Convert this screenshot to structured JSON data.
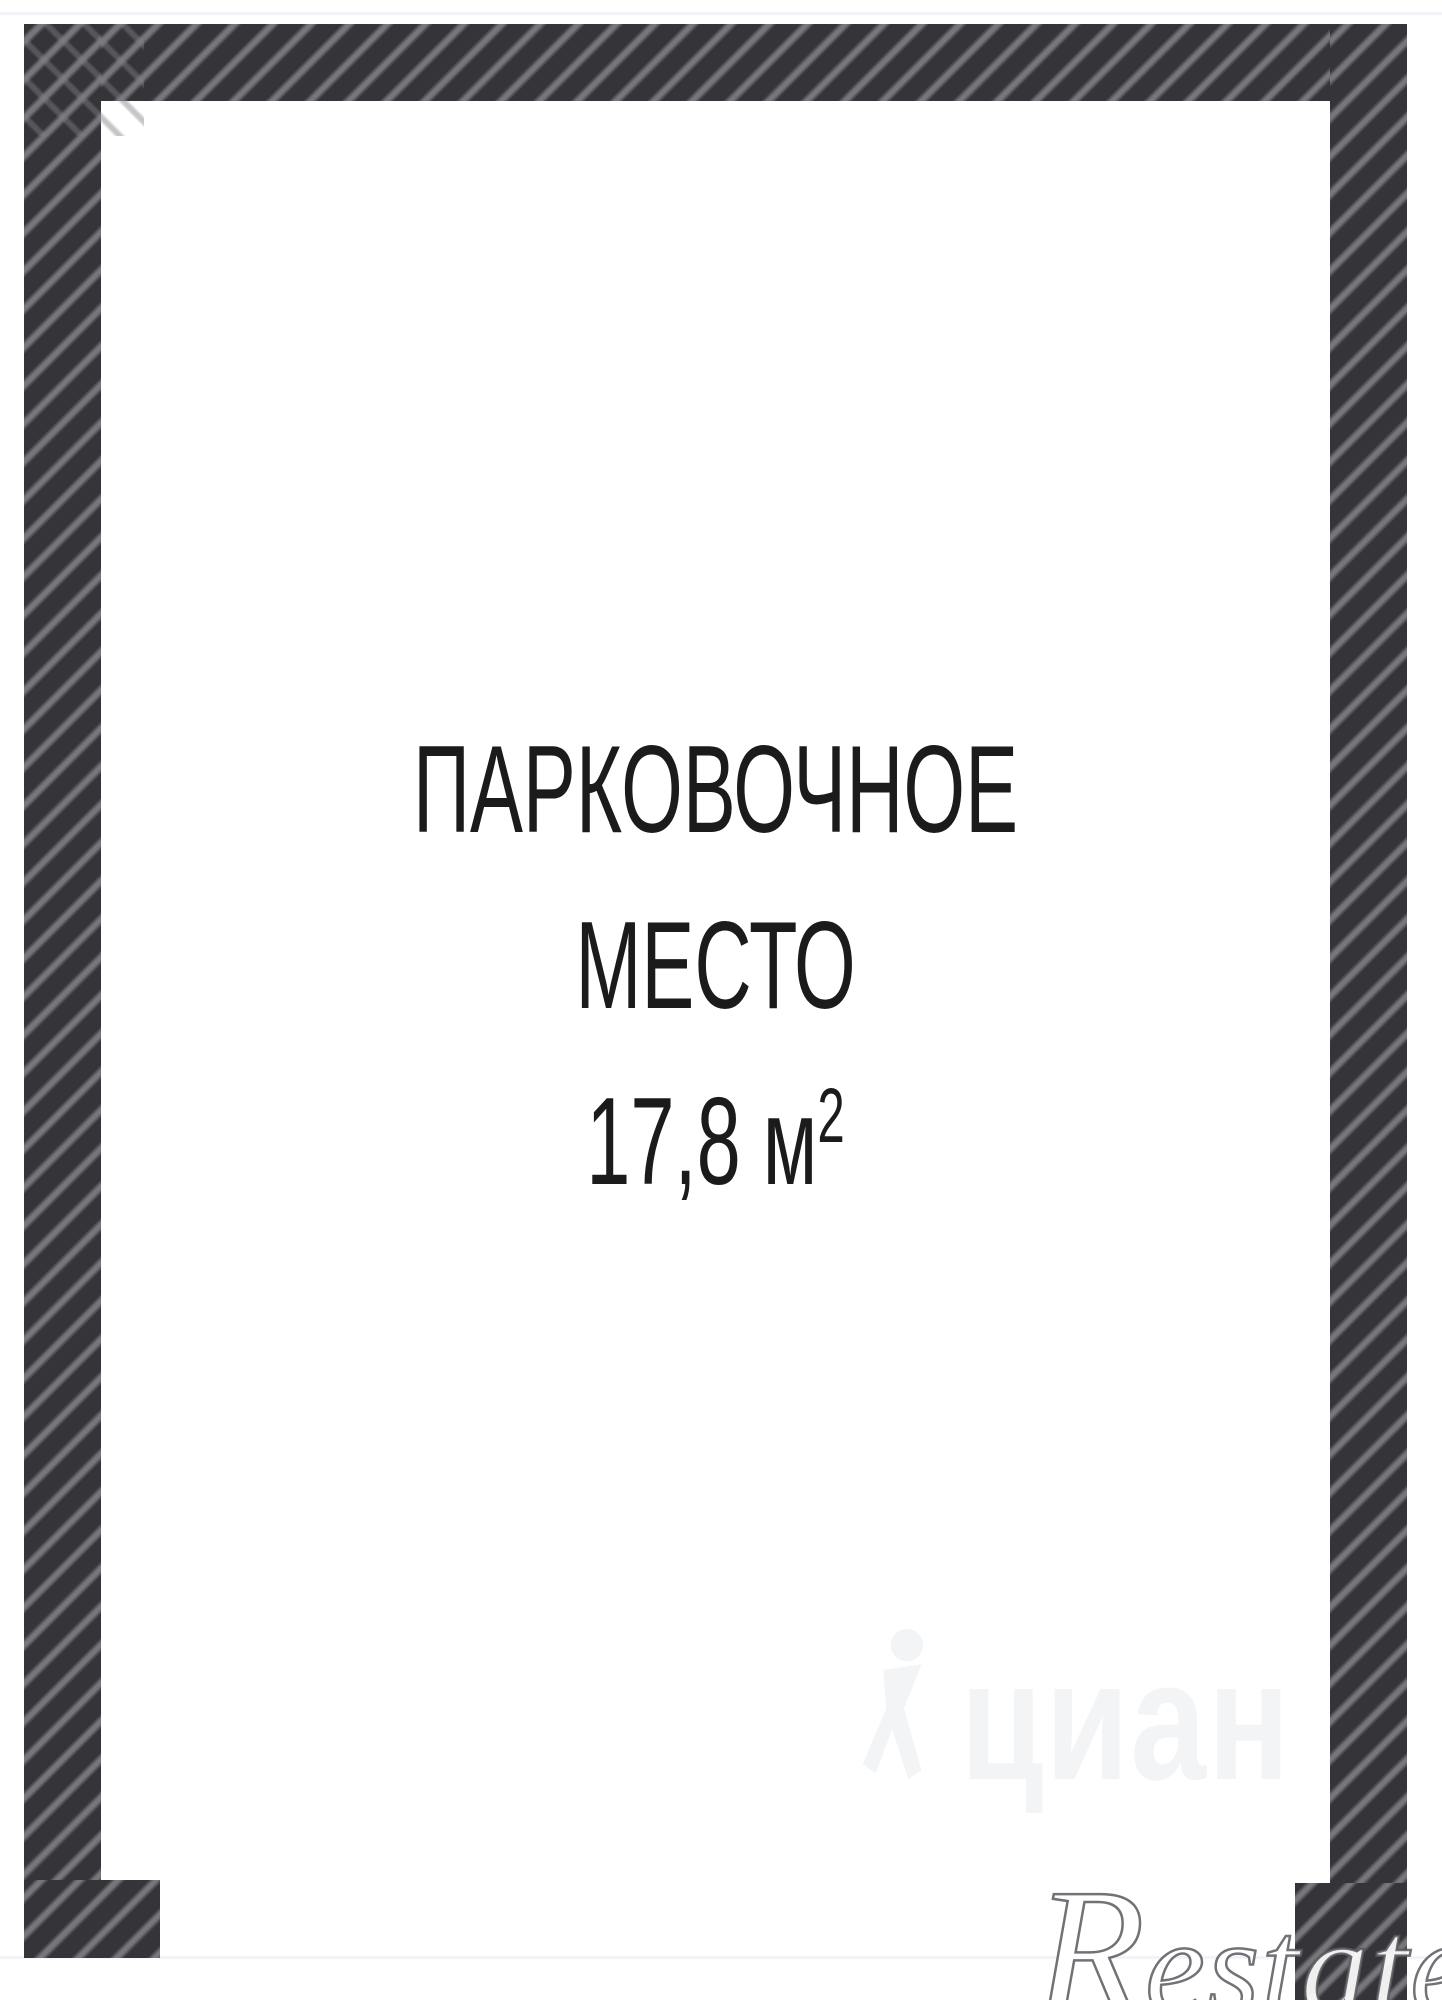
{
  "plan": {
    "label_line1": "ПАРКОВОЧНОЕ",
    "label_line2": "МЕСТО",
    "area_main": "17,8 м",
    "area_sup": "2"
  },
  "watermarks": {
    "cian_text": "циан",
    "cian_icon": "cian-person-icon",
    "restate_initial": "R",
    "restate_rest": "estate"
  },
  "colors": {
    "wall_base": "#343439",
    "wall_stripe": "#76767b",
    "label_text": "#1b1b1b",
    "cian_watermark": "#f3f4f6",
    "restate_stroke": "#58585e",
    "edge_line": "#ecf1f5",
    "background": "#ffffff"
  }
}
